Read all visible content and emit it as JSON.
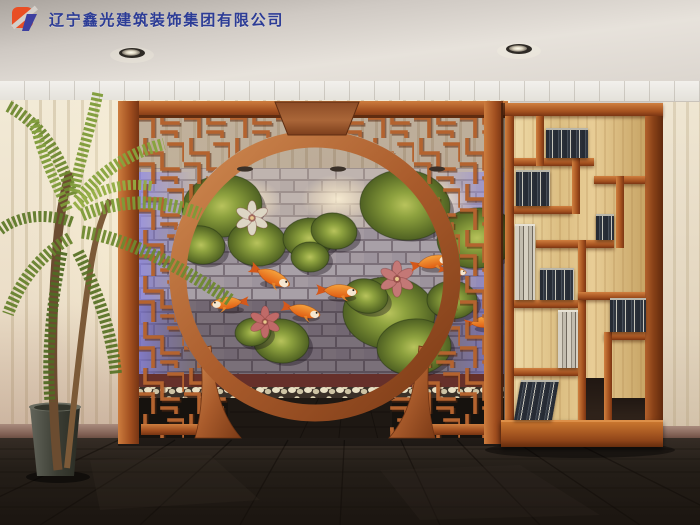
{
  "watermark": {
    "company_name": "辽宁鑫光建筑装饰集团有限公司",
    "logo": "xinguang-logo-mark"
  },
  "palette": {
    "wood": "#a4511f",
    "wood_light": "#d0803f",
    "wood_dark": "#7b3513",
    "wallpaper": "#efe7d3",
    "brick_wall": "#a29aa2",
    "led_purple": "#8a84e0",
    "koi_orange": "#ee7d22",
    "leaf_green": "#7d8f35",
    "lotus_pink": "#c06a68",
    "lotus_white": "#ddd6c4",
    "pebble": "#e9e0c4",
    "floor": "#241e18",
    "ceiling": "#d9d4cd",
    "shelf_back_maple": "#e0c288",
    "logo_orange": "#e94e24",
    "logo_blue": "#3d3f9f",
    "logo_text": "#2c3c96"
  },
  "scene": {
    "downlights": [
      {
        "x": 132,
        "y": 53
      },
      {
        "x": 519,
        "y": 49
      }
    ],
    "spotlights": [
      {
        "x": 245
      },
      {
        "x": 338
      },
      {
        "x": 437
      }
    ],
    "leaves": [
      {
        "x": 222,
        "y": 206,
        "rx": 40,
        "ry": 31,
        "rot": -8
      },
      {
        "x": 201,
        "y": 245,
        "rx": 24,
        "ry": 19,
        "rot": 10
      },
      {
        "x": 257,
        "y": 243,
        "rx": 29,
        "ry": 23,
        "rot": 4
      },
      {
        "x": 309,
        "y": 238,
        "rx": 26,
        "ry": 20,
        "rot": -5
      },
      {
        "x": 334,
        "y": 231,
        "rx": 23,
        "ry": 18,
        "rot": 8
      },
      {
        "x": 310,
        "y": 257,
        "rx": 19,
        "ry": 15,
        "rot": 0
      },
      {
        "x": 281,
        "y": 341,
        "rx": 28,
        "ry": 22,
        "rot": 6
      },
      {
        "x": 253,
        "y": 332,
        "rx": 18,
        "ry": 14,
        "rot": -9
      },
      {
        "x": 405,
        "y": 205,
        "rx": 45,
        "ry": 35,
        "rot": 5
      },
      {
        "x": 477,
        "y": 238,
        "rx": 40,
        "ry": 30,
        "rot": -6
      },
      {
        "x": 389,
        "y": 313,
        "rx": 46,
        "ry": 36,
        "rot": 3
      },
      {
        "x": 414,
        "y": 347,
        "rx": 37,
        "ry": 28,
        "rot": -4
      },
      {
        "x": 366,
        "y": 296,
        "rx": 22,
        "ry": 17,
        "rot": 12
      },
      {
        "x": 452,
        "y": 300,
        "rx": 25,
        "ry": 19,
        "rot": 0
      }
    ],
    "flowers": [
      {
        "x": 265,
        "y": 322,
        "s": 1.15,
        "color": "#c06a68"
      },
      {
        "x": 397,
        "y": 279,
        "s": 1.3,
        "color": "#c47876"
      },
      {
        "x": 252,
        "y": 218,
        "s": 1.25,
        "color": "#ddd6c4"
      }
    ],
    "koi": [
      {
        "x": 272,
        "y": 277,
        "rot": 25,
        "s": 1.15,
        "flip": false
      },
      {
        "x": 228,
        "y": 303,
        "rot": -5,
        "s": 1.0,
        "flip": true
      },
      {
        "x": 303,
        "y": 311,
        "rot": 14,
        "s": 1.05,
        "flip": false
      },
      {
        "x": 339,
        "y": 291,
        "rot": 3,
        "s": 1.1,
        "flip": false
      },
      {
        "x": 432,
        "y": 262,
        "rot": -12,
        "s": 1.05,
        "flip": false
      },
      {
        "x": 454,
        "y": 271,
        "rot": 8,
        "s": 0.75,
        "flip": false
      },
      {
        "x": 484,
        "y": 322,
        "rot": -6,
        "s": 0.95,
        "flip": false
      }
    ]
  },
  "shelf": {
    "backs": [
      {
        "x": 514,
        "y": 116,
        "w": 131,
        "h": 304
      }
    ],
    "voids": [
      {
        "x": 586,
        "y": 378,
        "w": 18,
        "h": 42
      },
      {
        "x": 612,
        "y": 398,
        "w": 33,
        "h": 22
      }
    ],
    "dividers": [
      {
        "x": 505,
        "y": 103,
        "w": 158,
        "h": 13,
        "o": "h"
      },
      {
        "x": 505,
        "y": 116,
        "w": 9,
        "h": 306,
        "o": "v"
      },
      {
        "x": 645,
        "y": 116,
        "w": 18,
        "h": 306,
        "o": "side"
      },
      {
        "x": 501,
        "y": 420,
        "w": 162,
        "h": 27,
        "o": "base"
      },
      {
        "x": 514,
        "y": 158,
        "w": 80,
        "h": 8,
        "o": "h"
      },
      {
        "x": 594,
        "y": 176,
        "w": 51,
        "h": 8,
        "o": "h"
      },
      {
        "x": 536,
        "y": 116,
        "w": 8,
        "h": 50,
        "o": "v"
      },
      {
        "x": 514,
        "y": 206,
        "w": 58,
        "h": 8,
        "o": "h"
      },
      {
        "x": 572,
        "y": 158,
        "w": 8,
        "h": 56,
        "o": "v"
      },
      {
        "x": 536,
        "y": 240,
        "w": 78,
        "h": 8,
        "o": "h"
      },
      {
        "x": 616,
        "y": 176,
        "w": 8,
        "h": 72,
        "o": "v"
      },
      {
        "x": 514,
        "y": 300,
        "w": 64,
        "h": 8,
        "o": "h"
      },
      {
        "x": 578,
        "y": 240,
        "w": 8,
        "h": 180,
        "o": "v"
      },
      {
        "x": 578,
        "y": 292,
        "w": 67,
        "h": 8,
        "o": "h"
      },
      {
        "x": 604,
        "y": 332,
        "w": 41,
        "h": 8,
        "o": "h"
      },
      {
        "x": 604,
        "y": 332,
        "w": 8,
        "h": 88,
        "o": "v"
      },
      {
        "x": 514,
        "y": 368,
        "w": 64,
        "h": 8,
        "o": "h"
      }
    ],
    "books": [
      {
        "x": 546,
        "y": 128,
        "w": 42,
        "h": 30,
        "kind": "dark"
      },
      {
        "x": 516,
        "y": 170,
        "w": 34,
        "h": 36,
        "kind": "dark"
      },
      {
        "x": 515,
        "y": 224,
        "w": 20,
        "h": 76,
        "kind": "light"
      },
      {
        "x": 540,
        "y": 268,
        "w": 34,
        "h": 32,
        "kind": "dark"
      },
      {
        "x": 596,
        "y": 214,
        "w": 18,
        "h": 26,
        "kind": "dark"
      },
      {
        "x": 558,
        "y": 310,
        "w": 20,
        "h": 58,
        "kind": "light"
      },
      {
        "x": 610,
        "y": 298,
        "w": 36,
        "h": 34,
        "kind": "dark"
      },
      {
        "x": 514,
        "y": 380,
        "w": 38,
        "h": 40,
        "kind": "dark",
        "lean": true
      }
    ]
  }
}
